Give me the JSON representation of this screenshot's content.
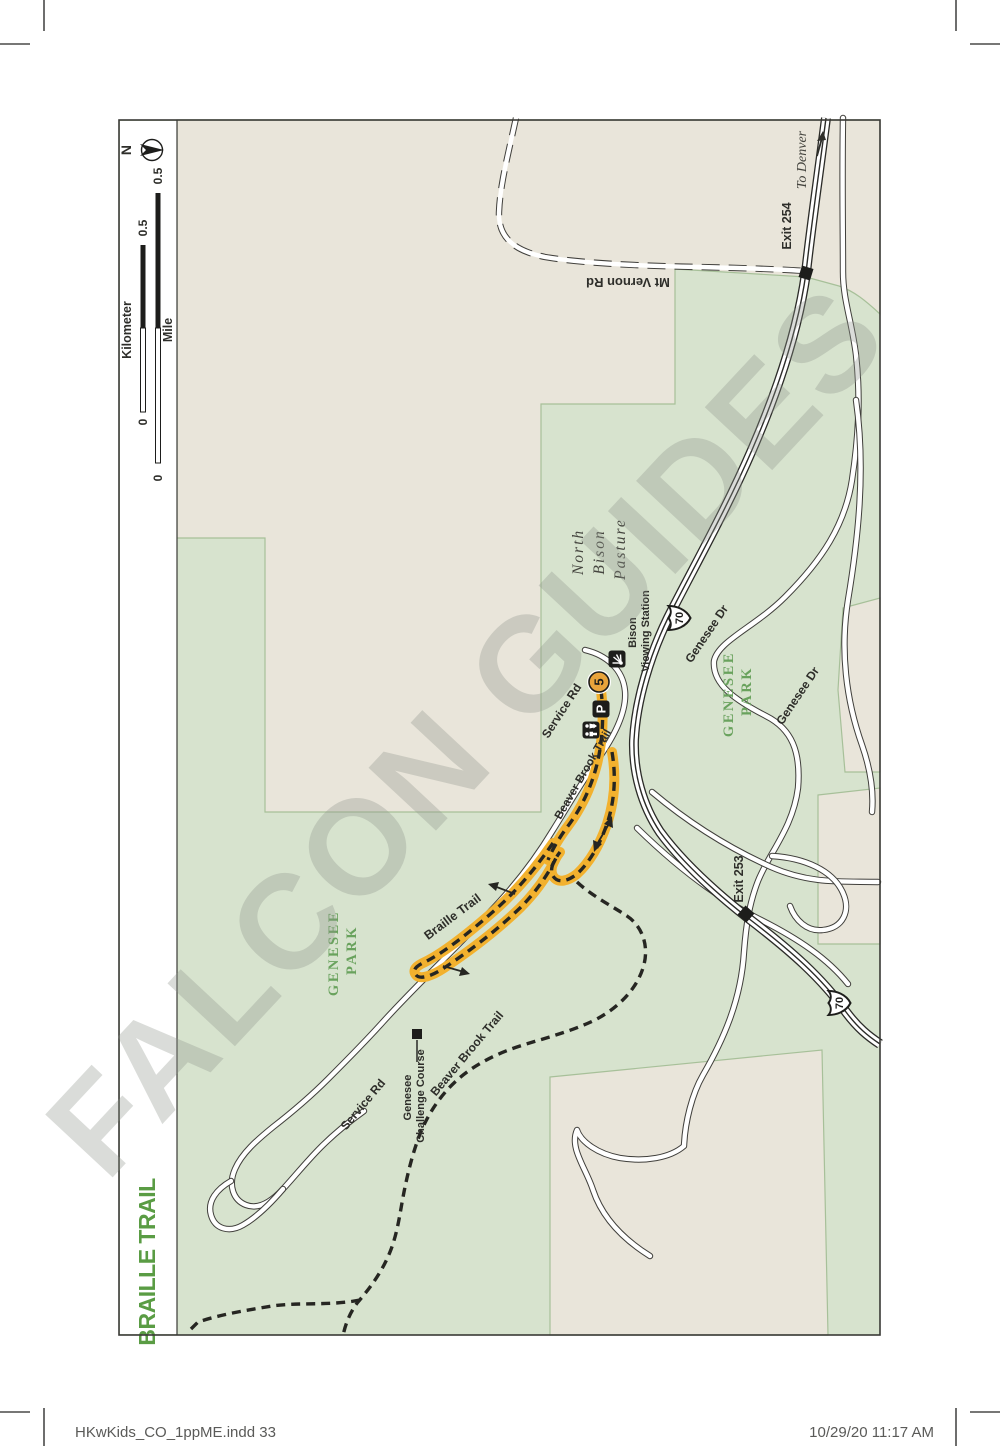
{
  "page": {
    "footer_left": "HKwKids_CO_1ppME.indd   33",
    "footer_right": "10/29/20   11:17 AM"
  },
  "map": {
    "title": "BRAILLE TRAIL",
    "watermark": "FALCON GUIDES",
    "compass": {
      "north_label": "N"
    },
    "scale": {
      "kilometer_label": "Kilometer",
      "mile_label": "Mile",
      "km_zero": "0",
      "km_max": "0.5",
      "mile_zero": "0",
      "mile_max": "0.5"
    },
    "labels": {
      "to_denver": "To Denver",
      "exit_254": "Exit 254",
      "exit_253": "Exit 253",
      "mt_vernon_rd": "Mt Vernon Rd",
      "north_bison_pasture": [
        "North",
        "Bison",
        "Pasture"
      ],
      "bison_viewing_station": [
        "Bison",
        "Viewing Station"
      ],
      "service_rd": "Service Rd",
      "genesee_dr": "Genesee Dr",
      "genesee_park": [
        "GENESEE",
        "PARK"
      ],
      "braille_trail": "Braille Trail",
      "beaver_brook_trail": "Beaver Brook Trail",
      "genesee_challenge_course": [
        "Genesee",
        "Challenge Course"
      ]
    },
    "markers": {
      "interstate_shield": "70",
      "trailhead_number": "5",
      "parking": "P"
    },
    "colors": {
      "park_green": "#d7e3ce",
      "land_beige": "#e9e5da",
      "trail_highlight_yellow": "#f2b12e",
      "title_green": "#5a9c44",
      "park_label_green": "#69a25d",
      "watermark_gray": "#8f948c"
    }
  }
}
